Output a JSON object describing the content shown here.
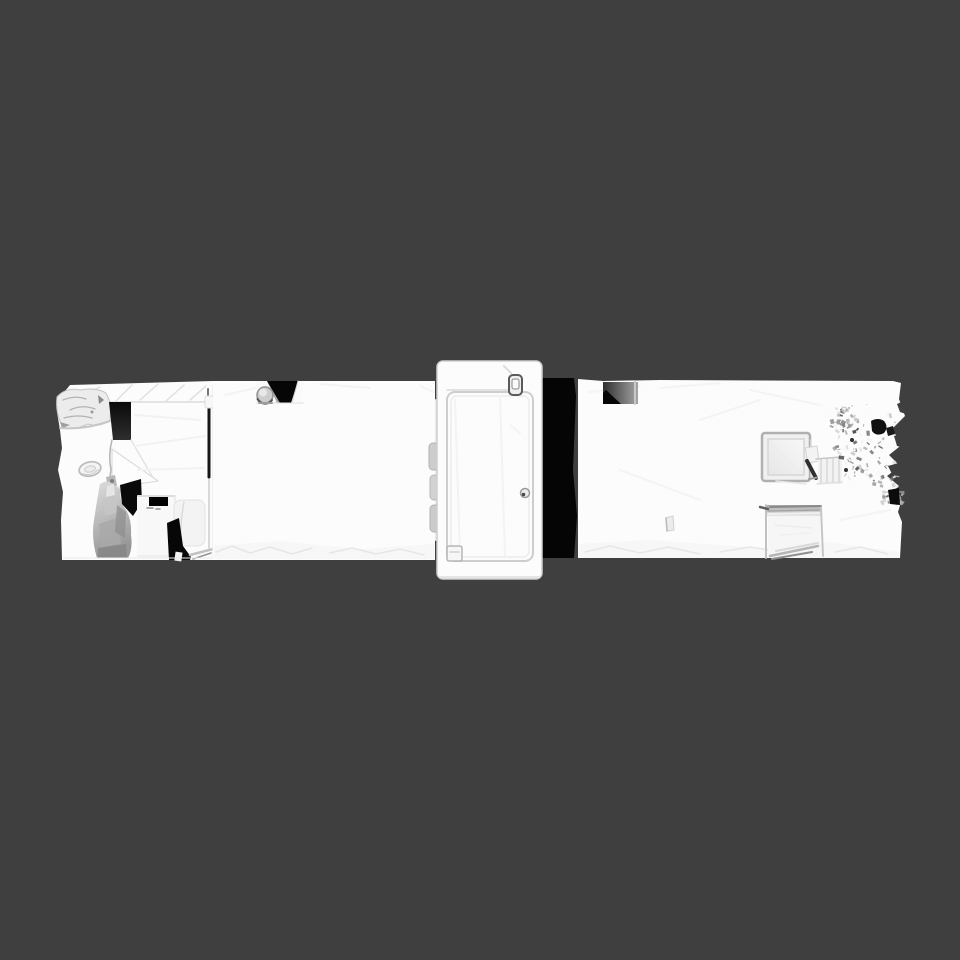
{
  "viewport": {
    "background_color": "#3f3f3f",
    "mesh": {
      "base_color": "#fcfcfc",
      "shade_color": "#e8e8e8",
      "hole_color": "#050505",
      "cloth_dark": "#969696",
      "noise_palette": [
        "#d2d2d2",
        "#b8b8b8",
        "#9c9c9c",
        "#808080",
        "#636363",
        "#efefef",
        "#f8f8f8",
        "#4a4a4a"
      ],
      "elements": [
        "left-room-mesh",
        "rough-mesh-blob",
        "doorway-gap",
        "open-door-leaf",
        "wall-oval-fixture",
        "draped-cloth",
        "appliance-box",
        "toilet-object",
        "interior-wall-edge",
        "middle-room-mesh",
        "top-notch-with-pipe-knob",
        "detached-door-panel",
        "door-inner-frame",
        "door-handle",
        "door-knob",
        "door-hinges",
        "door-foot-bracket",
        "scan-hole",
        "right-room-mesh",
        "top-doorway-notch",
        "skylight-frame",
        "small-dark-object",
        "radiator-streaks",
        "stair-opening",
        "torn-mesh-noise",
        "scan-hole-small",
        "floor-fleck"
      ]
    }
  }
}
